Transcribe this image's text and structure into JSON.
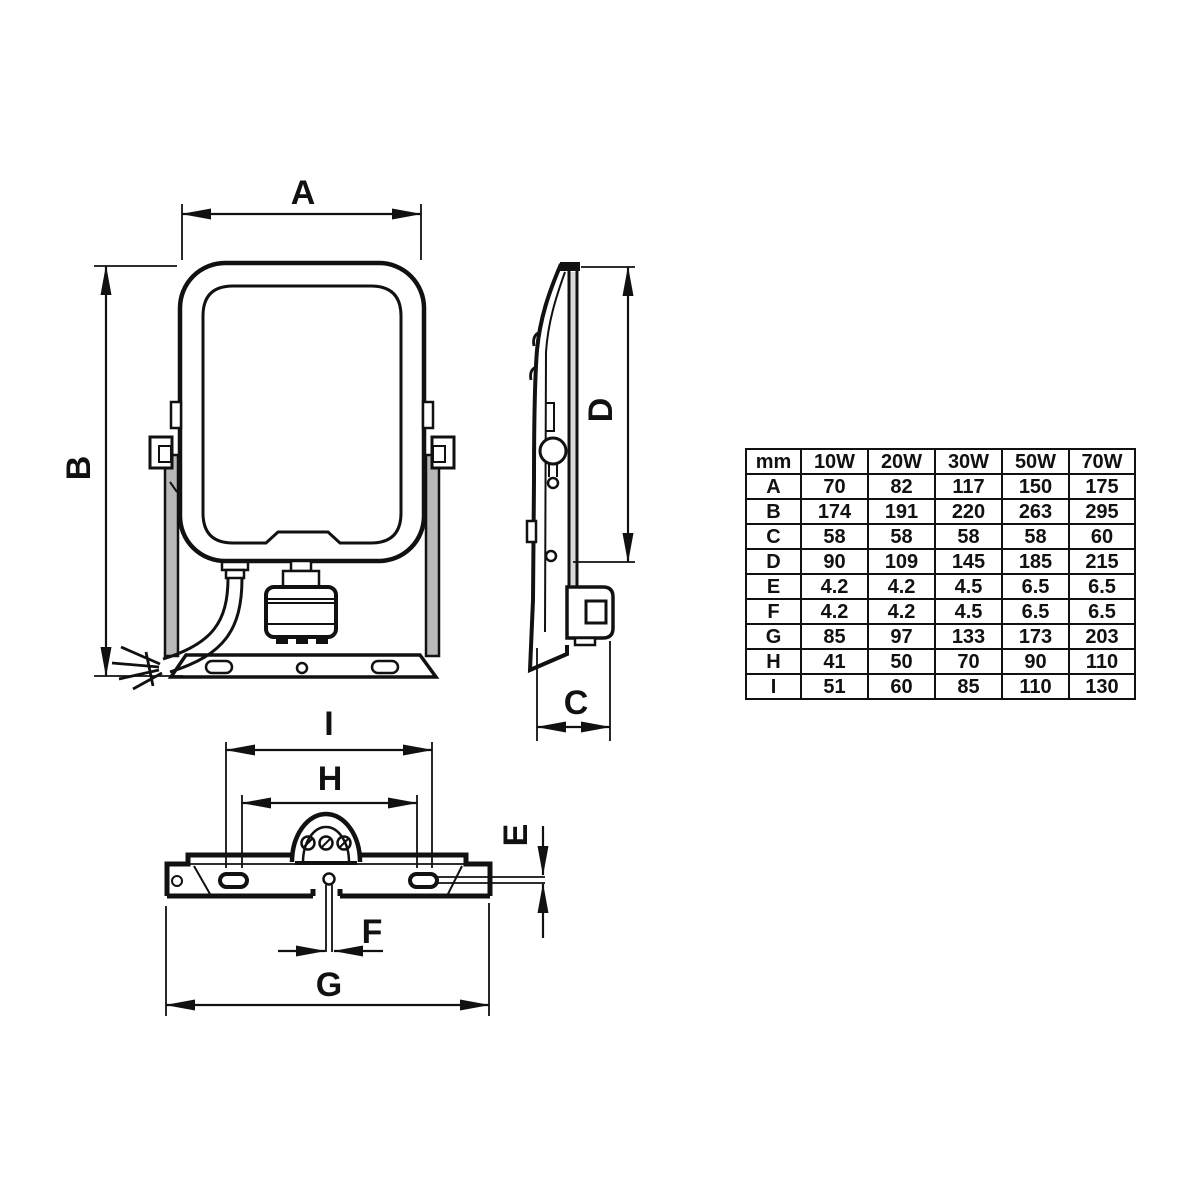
{
  "labels": {
    "A": "A",
    "B": "B",
    "C": "C",
    "D": "D",
    "E": "E",
    "F": "F",
    "G": "G",
    "H": "H",
    "I": "I"
  },
  "table": {
    "headers": [
      "mm",
      "10W",
      "20W",
      "30W",
      "50W",
      "70W"
    ],
    "rows": [
      {
        "label": "A",
        "values": [
          "70",
          "82",
          "117",
          "150",
          "175"
        ]
      },
      {
        "label": "B",
        "values": [
          "174",
          "191",
          "220",
          "263",
          "295"
        ]
      },
      {
        "label": "C",
        "values": [
          "58",
          "58",
          "58",
          "58",
          "60"
        ]
      },
      {
        "label": "D",
        "values": [
          "90",
          "109",
          "145",
          "185",
          "215"
        ]
      },
      {
        "label": "E",
        "values": [
          "4.2",
          "4.2",
          "4.5",
          "6.5",
          "6.5"
        ]
      },
      {
        "label": "F",
        "values": [
          "4.2",
          "4.2",
          "4.5",
          "6.5",
          "6.5"
        ]
      },
      {
        "label": "G",
        "values": [
          "85",
          "97",
          "133",
          "173",
          "203"
        ]
      },
      {
        "label": "H",
        "values": [
          "41",
          "50",
          "70",
          "90",
          "110"
        ]
      },
      {
        "label": "I",
        "values": [
          "51",
          "60",
          "85",
          "110",
          "130"
        ]
      }
    ]
  },
  "colors": {
    "line": "#111111",
    "background": "#ffffff",
    "shade": "#b8b8b8"
  }
}
